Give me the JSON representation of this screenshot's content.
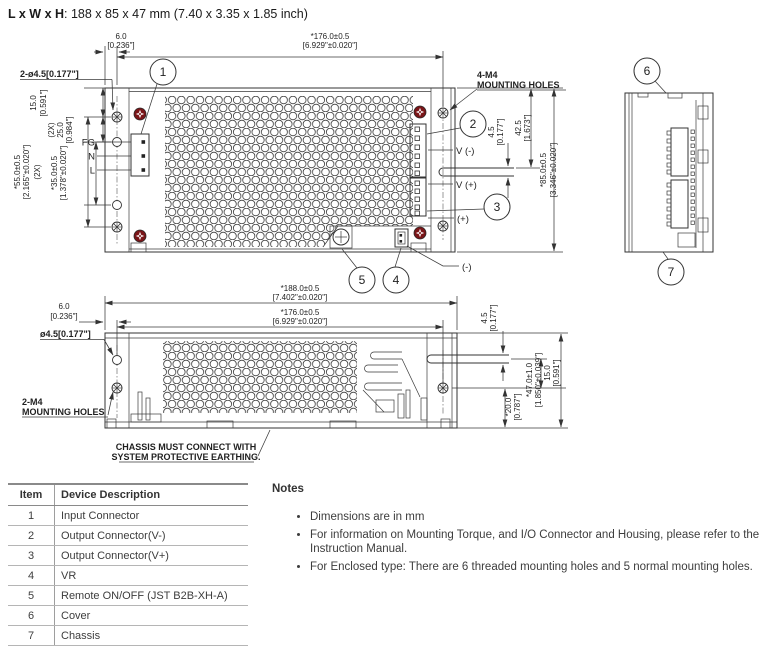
{
  "title": {
    "bold": "L x W x H",
    "rest": ": 188 x 85 x 47 mm (7.40 x 3.35 x 1.85 inch)"
  },
  "top_view": {
    "dims": {
      "d6": {
        "mm": "6.0",
        "inch": "[0.236\"]"
      },
      "d176": {
        "mm": "*176.0±0.5",
        "inch": "[6.929\"±0.020\"]"
      },
      "d15": {
        "mm": "15.0",
        "inch": "[0.591\"]"
      },
      "d25": {
        "qty": "(2X)",
        "mm": "25.0",
        "inch": "[0.984\"]"
      },
      "d55": {
        "qty": "(2X)",
        "mm": "*55.0±0.5",
        "inch": "[2.165\"±0.020\"]"
      },
      "d35": {
        "mm": "*35.0±0.5",
        "inch": "[1.378\"±0.020\"]"
      },
      "d45": {
        "mm": "4.5",
        "inch": "[0.177\"]"
      },
      "d425": {
        "mm": "42.5",
        "inch": "[1.673\"]"
      },
      "d85": {
        "mm": "*85.0±0.5",
        "inch": "[3.346\"±0.020\"]"
      }
    },
    "labels": {
      "holes": "2-ø4.5[0.177\"]",
      "m4a": "4-M4",
      "m4b": "MOUNTING HOLES",
      "fg": "FG",
      "n": "N",
      "l": "L",
      "v_minus": "V (-)",
      "v_plus": "V (+)",
      "plus": "(+)",
      "minus": "(-)"
    },
    "balloons": {
      "b1": "1",
      "b2": "2",
      "b3": "3",
      "b4": "4",
      "b5": "5"
    }
  },
  "side_view": {
    "balloons": {
      "b6": "6",
      "b7": "7"
    }
  },
  "front_view": {
    "dims": {
      "d188": {
        "mm": "*188.0±0.5",
        "inch": "[7.402\"±0.020\"]"
      },
      "d176": {
        "mm": "*176.0±0.5",
        "inch": "[6.929\"±0.020\"]"
      },
      "d6": {
        "mm": "6.0",
        "inch": "[0.236\"]"
      },
      "d45": {
        "mm": "4.5",
        "inch": "[0.177\"]"
      },
      "d15": {
        "mm": "15.0",
        "inch": "[0.591\"]"
      },
      "d20": {
        "mm": "*20.0",
        "inch": "[0.787\"]"
      },
      "d47": {
        "mm": "*47.0±1.0",
        "inch": "[1.850\"±0.039\"]"
      }
    },
    "labels": {
      "hole": "ø4.5[0.177\"]",
      "m4a": "2-M4",
      "m4b": "MOUNTING HOLES",
      "earth1": "CHASSIS MUST CONNECT WITH",
      "earth2": "SYSTEM PROTECTIVE EARTHING."
    }
  },
  "table": {
    "headers": [
      "Item",
      "Device Description"
    ],
    "rows": [
      [
        "1",
        "Input Connector"
      ],
      [
        "2",
        "Output Connector(V-)"
      ],
      [
        "3",
        "Output Connector(V+)"
      ],
      [
        "4",
        "VR"
      ],
      [
        "5",
        "Remote ON/OFF (JST B2B-XH-A)"
      ],
      [
        "6",
        "Cover"
      ],
      [
        "7",
        "Chassis"
      ]
    ]
  },
  "notes": {
    "heading": "Notes",
    "items": [
      "Dimensions are in mm",
      "For information on Mounting Torque, and I/O Connector and Housing, please refer to the Instruction Manual.",
      "For Enclosed type: There are 6 threaded mounting holes and 5 normal mounting holes."
    ]
  },
  "colors": {
    "line": "#333333",
    "screw_red": "#7a1518",
    "text": "#3d3d3d"
  }
}
